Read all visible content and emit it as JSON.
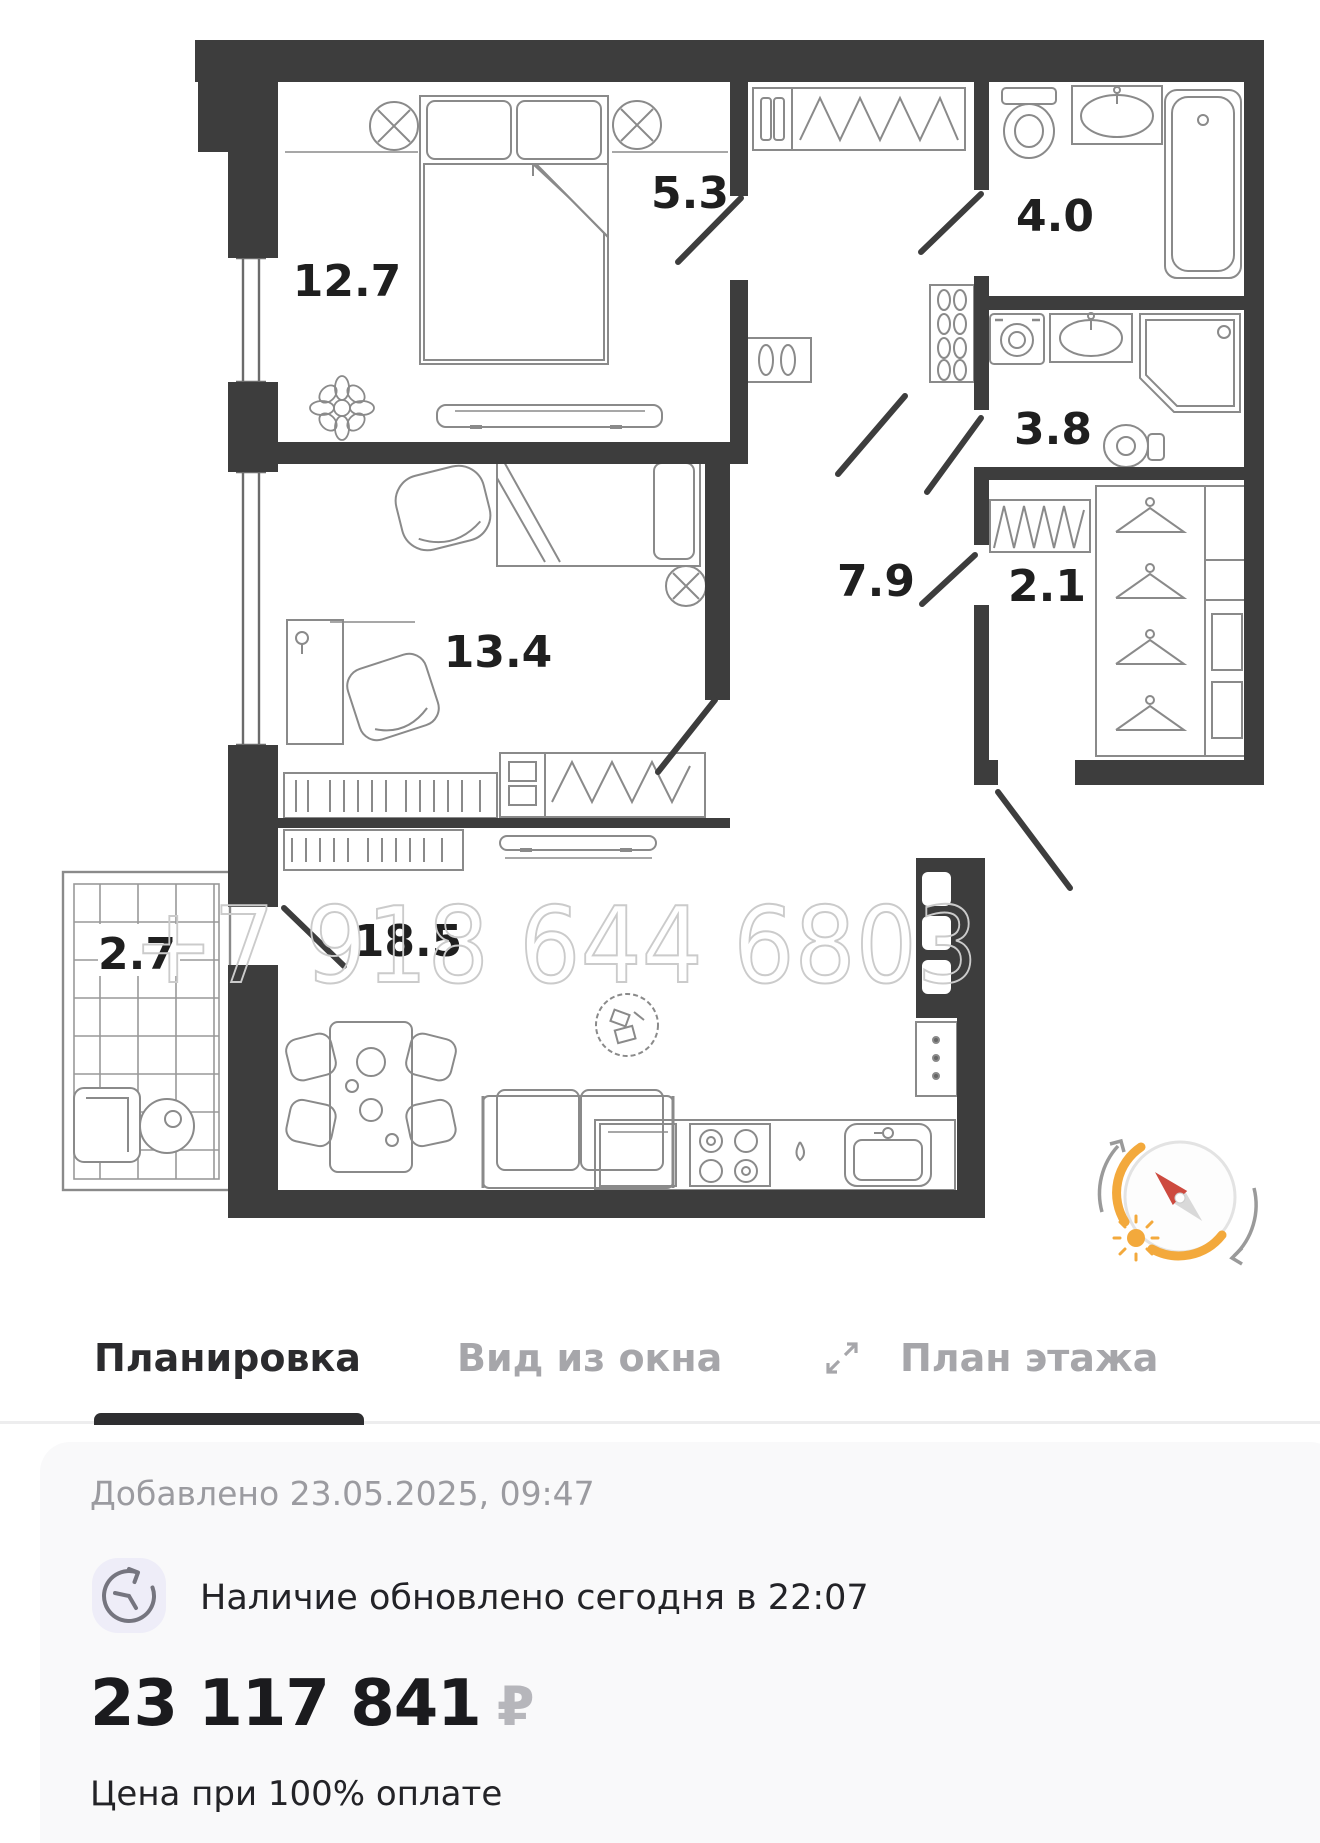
{
  "floor_plan": {
    "watermark": "+7 918 644 6803",
    "rooms": [
      {
        "name": "bedroom-1",
        "area": "12.7"
      },
      {
        "name": "hallway",
        "area": "5.3"
      },
      {
        "name": "bathroom-1",
        "area": "4.0"
      },
      {
        "name": "bathroom-2",
        "area": "3.8"
      },
      {
        "name": "bedroom-2",
        "area": "13.4"
      },
      {
        "name": "corridor",
        "area": "7.9"
      },
      {
        "name": "wardrobe",
        "area": "2.1"
      },
      {
        "name": "balcony",
        "area": "2.7"
      },
      {
        "name": "kitchen-living",
        "area": "18.5"
      }
    ],
    "colors": {
      "wall": "#3D3D3D",
      "furniture_line": "#8A8A8A",
      "watermark": "#CBCBCB",
      "compass_accent": "#F3A93C",
      "compass_needle": "#CD4A3F"
    }
  },
  "tabs": {
    "items": [
      {
        "label": "Планировка",
        "active": true
      },
      {
        "label": "Вид из окна",
        "active": false
      },
      {
        "label": "План этажа",
        "active": false
      }
    ]
  },
  "listing": {
    "added": "Добавлено 23.05.2025, 09:47",
    "availability": "Наличие обновлено сегодня в 22:07",
    "price": "23 117 841",
    "currency": "₽",
    "price_note": "Цена при 100% оплате"
  }
}
